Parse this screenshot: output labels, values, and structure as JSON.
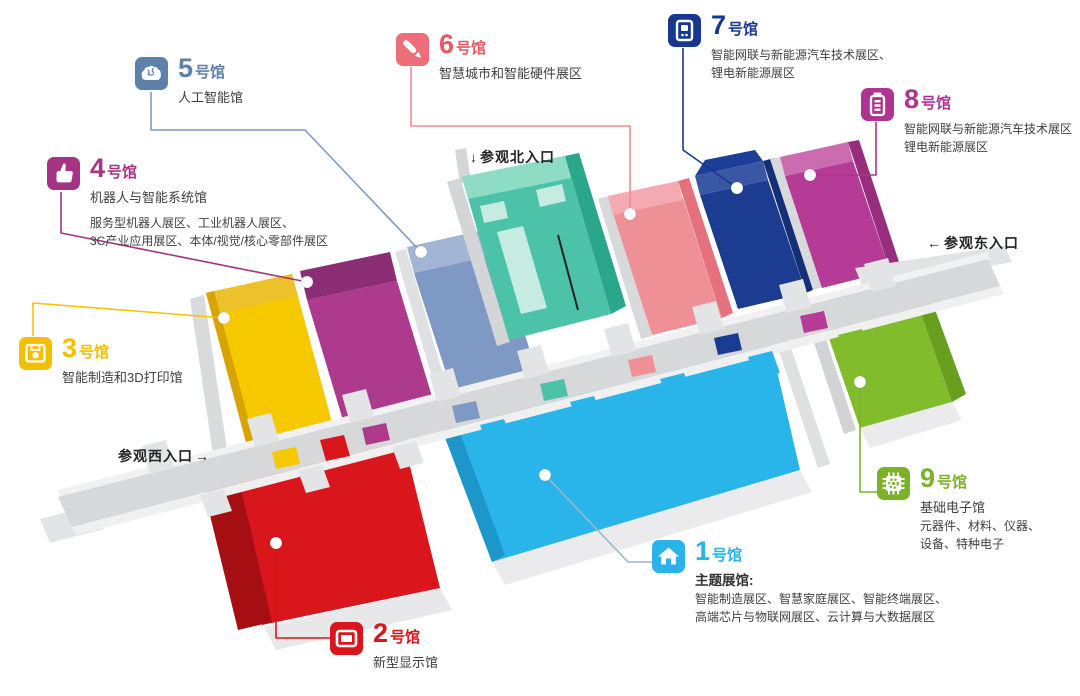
{
  "map": {
    "type": "exhibition-floor-plan",
    "corridor_color": "#d7d8da",
    "background": "#ffffff"
  },
  "halls": [
    {
      "num": "1",
      "suffix": "号馆",
      "name": "主题展馆:",
      "name_bold": true,
      "lines": [
        "智能制造展区、智慧家庭展区、智能终端展区、",
        "高端芯片与物联网展区、云计算与大数据展区"
      ],
      "color": "#29b3e8",
      "floor_color": "#2ab5ea",
      "icon": "home-icon"
    },
    {
      "num": "2",
      "suffix": "号馆",
      "name": "新型显示馆",
      "color": "#d8161b",
      "floor_color": "#d8161b",
      "icon": "display-icon"
    },
    {
      "num": "3",
      "suffix": "号馆",
      "name": "智能制造和3D打印馆",
      "color": "#f3c000",
      "floor_color": "#f6c800",
      "icon": "printer-3d-icon"
    },
    {
      "num": "4",
      "suffix": "号馆",
      "name": "机器人与智能系统馆",
      "lines": [
        "服务型机器人展区、工业机器人展区、",
        "3C产业应用展区、本体/视觉/核心零部件展区"
      ],
      "color": "#a53584",
      "floor_color": "#ad3a8c",
      "icon": "hand-icon"
    },
    {
      "num": "5",
      "suffix": "号馆",
      "name": "人工智能馆",
      "color": "#5e81ab",
      "floor_color": "#7e99c4",
      "icon": "brain-icon"
    },
    {
      "num": "6",
      "suffix": "号馆",
      "name": "智慧城市和智能硬件展区",
      "color": "#e85965",
      "floor_color": "#ef9097",
      "icon": "pen-icon"
    },
    {
      "num": "7",
      "suffix": "号馆",
      "lines": [
        "智能网联与新能源汽车技术展区、",
        "锂电新能源展区"
      ],
      "color": "#16388e",
      "floor_color": "#1c3c92",
      "icon": "charging-station-icon"
    },
    {
      "num": "8",
      "suffix": "号馆",
      "lines": [
        "智能网联与新能源汽车技术展区",
        "锂电新能源展区"
      ],
      "color": "#b03390",
      "floor_color": "#b53b96",
      "icon": "battery-icon"
    },
    {
      "num": "9",
      "suffix": "号馆",
      "name": "基础电子馆",
      "lines": [
        "元器件、材料、仪器、",
        "设备、特种电子"
      ],
      "color": "#7cb229",
      "floor_color": "#80bc2b",
      "icon": "chip-icon"
    }
  ],
  "entrances": {
    "north": "参观北入口",
    "north_arrow": "↓",
    "east": "参观东入口",
    "east_arrow": "←",
    "west": "参观西入口",
    "west_arrow": "→"
  }
}
